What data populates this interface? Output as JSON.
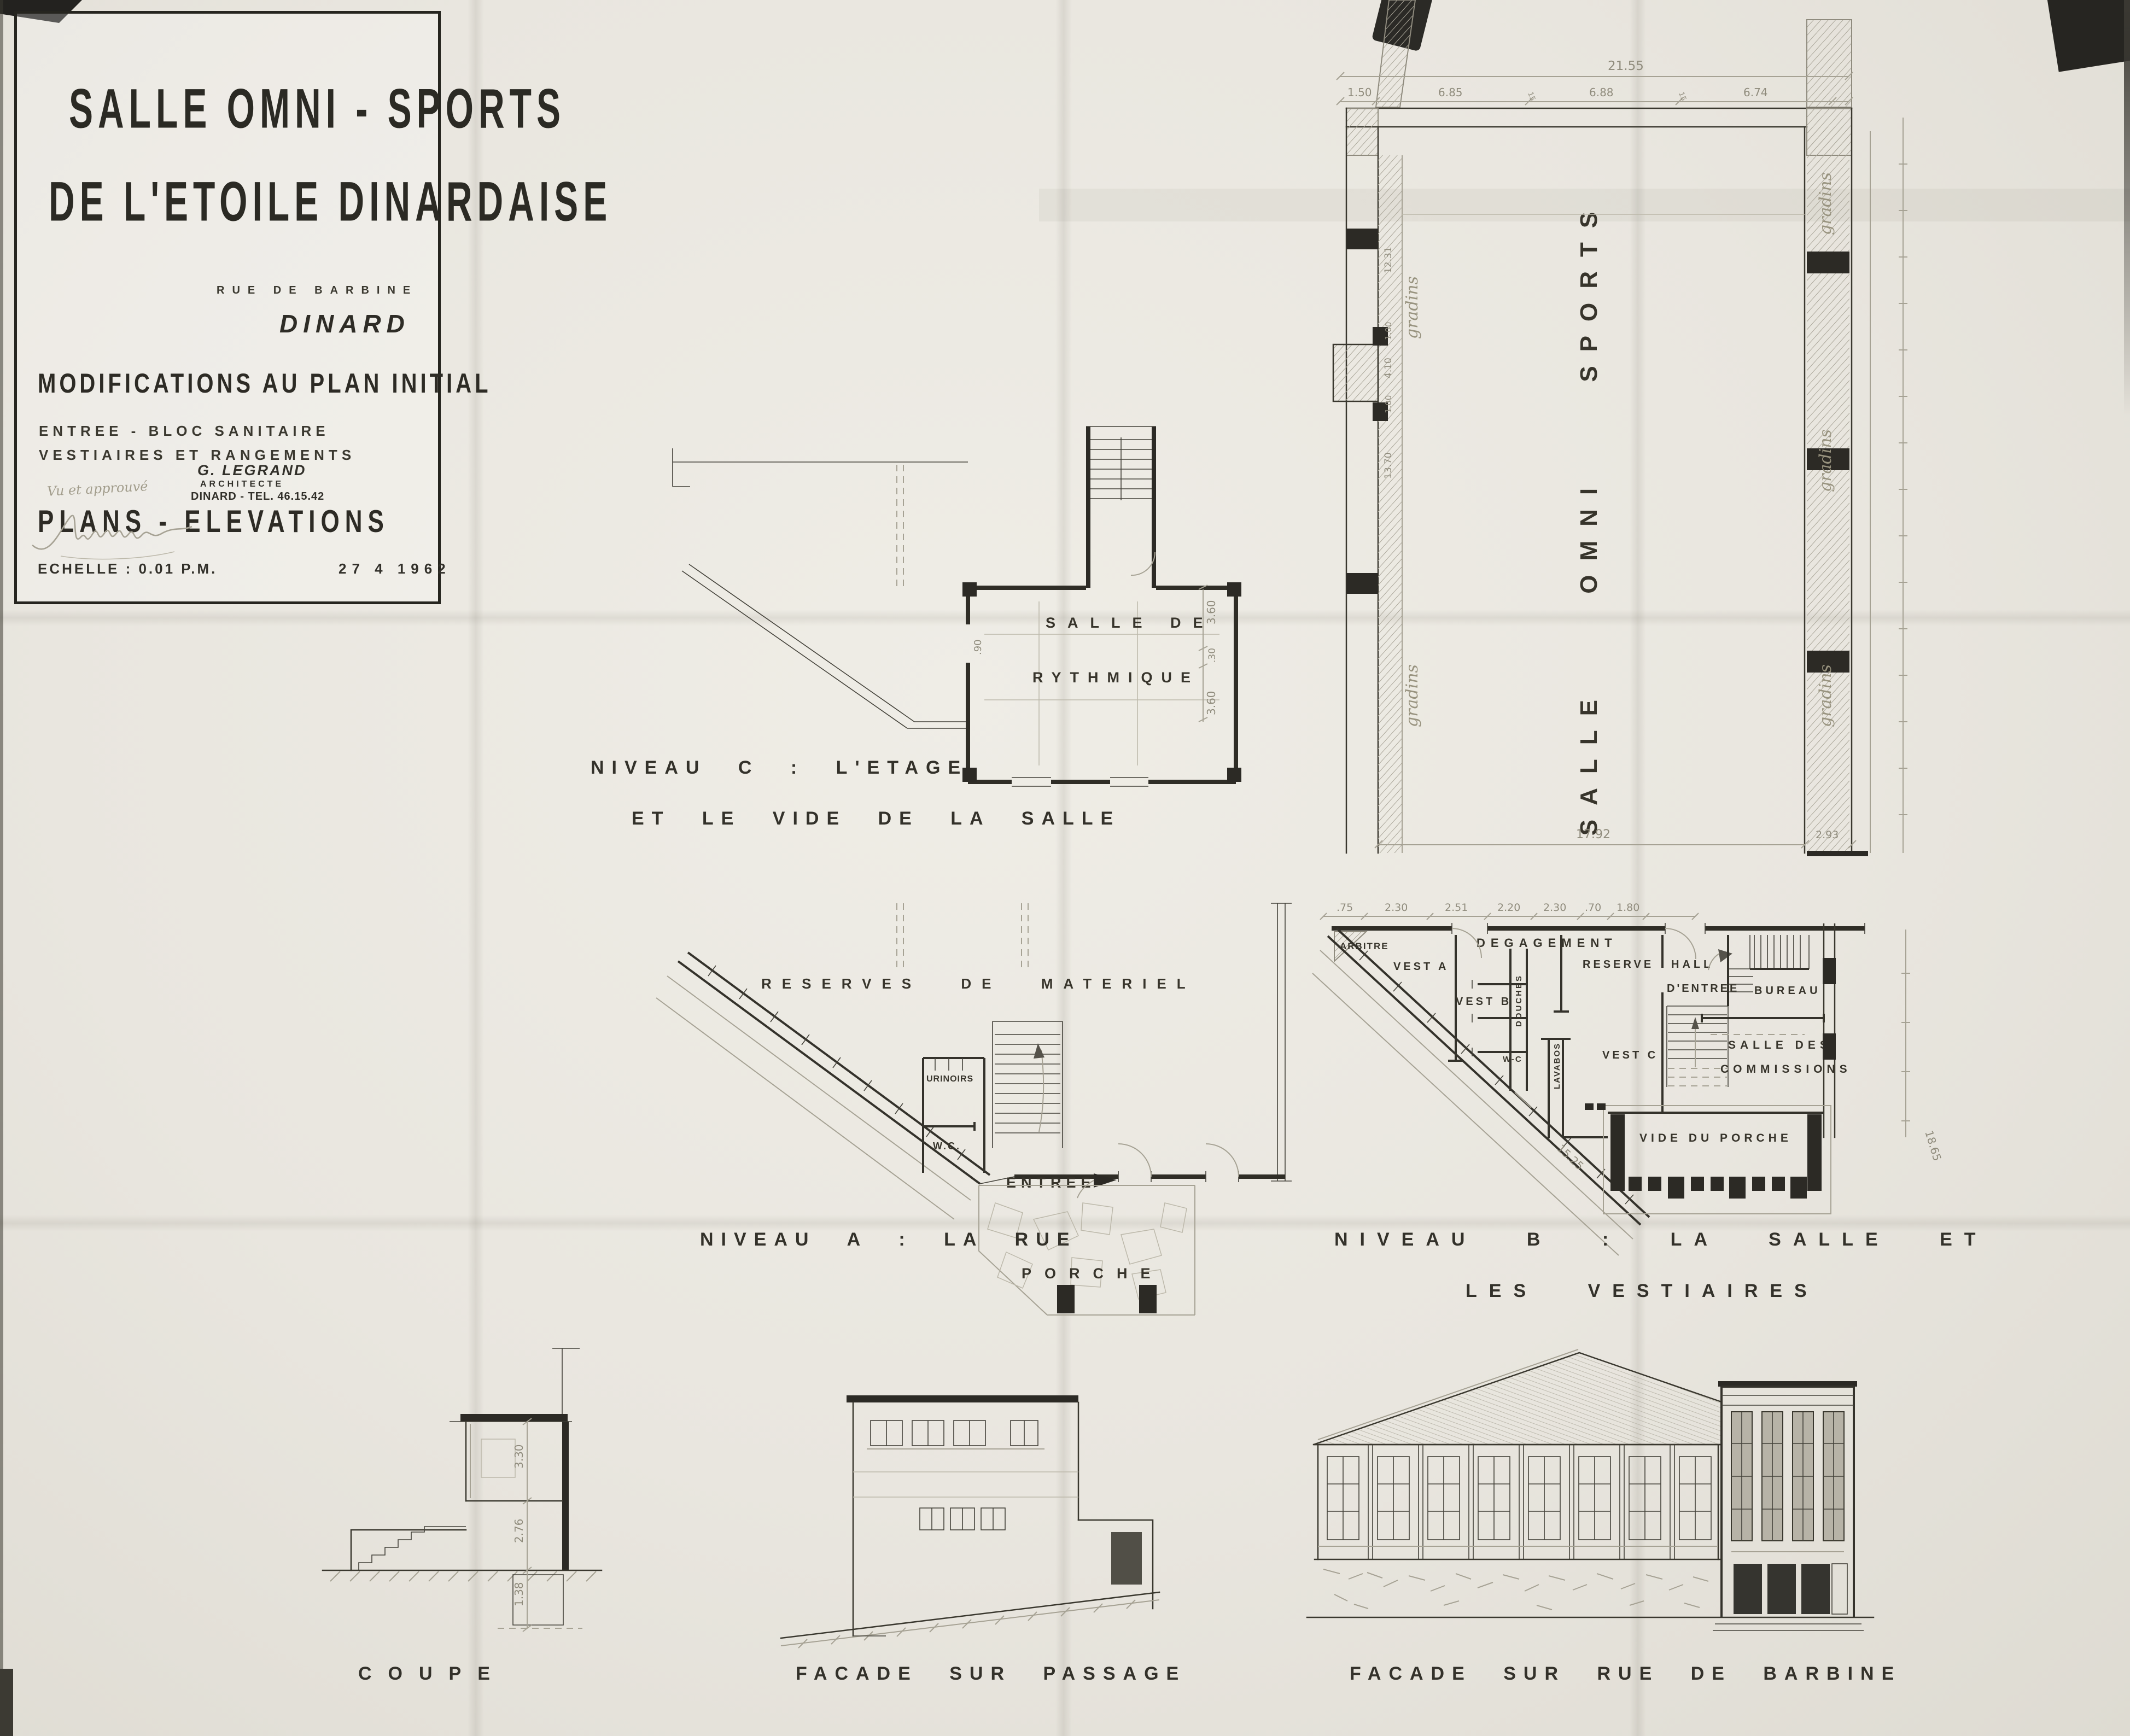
{
  "title_block": {
    "title_line1": "SALLE OMNI - SPORTS",
    "title_line2": "DE L'ETOILE DINARDAISE",
    "address": "RUE DE BARBINE",
    "city": "DINARD",
    "subject": "MODIFICATIONS AU PLAN INITIAL",
    "scope_line1": "ENTREE - BLOC SANITAIRE",
    "scope_line2": "VESTIAIRES ET RANGEMENTS",
    "doc_type": "PLANS - ELEVATIONS",
    "architect": {
      "name": "G. LEGRAND",
      "title": "ARCHITECTE",
      "contact": "DINARD - TEL. 46.15.42"
    },
    "approval": "Vu et approuvé",
    "scale": "ECHELLE : 0.01 P.M.",
    "date": "27 4 1962"
  },
  "niveau_c": {
    "caption1": "NIVEAU C : L'ETAGE",
    "caption2": "ET LE VIDE DE LA SALLE",
    "room_line1": "SALLE DE",
    "room_line2": "RYTHMIQUE",
    "dims": {
      "right_top": "3.60",
      "right_mid": ".30",
      "right_bottom": "3.60",
      "left": ".90"
    }
  },
  "niveau_a": {
    "caption": "NIVEAU A : LA RUE",
    "rooms": {
      "reserves": "RESERVES DE MATERIEL",
      "urinoirs": "URINOIRS",
      "wc": "W.C.",
      "entree": "ENTREE",
      "porche": "PORCHE"
    }
  },
  "niveau_b": {
    "caption1": "NIVEAU B : LA SALLE ET",
    "caption2": "LES VESTIAIRES",
    "hall": "SALLE OMNI SPORTS",
    "gradins": "gradins",
    "rooms": {
      "arbitre": "ARBITRE",
      "degagement": "DEGAGEMENT",
      "vest_a": "VEST A",
      "vest_b": "VEST B",
      "douches": "DOUCHES",
      "wc": "W-C",
      "lavabos": "LAVABOS",
      "reserve": "RESERVE",
      "vest_c": "VEST C",
      "hall_line1": "HALL",
      "hall_line2": "D'ENTREE",
      "bureau": "BUREAU",
      "commissions_line1": "SALLE DES",
      "commissions_line2": "COMMISSIONS",
      "vide_porche": "VIDE DU PORCHE"
    },
    "dims": {
      "total_top": "21.55",
      "seg1": "1.50",
      "seg2": "6.85",
      "seg3": "6.88",
      "seg4": "6.74",
      "wall": "15",
      "width": "17.92",
      "width_right": "2.93",
      "row1": ".75",
      "row2": "2.30",
      "row3": "2.51",
      "row4": "2.20",
      "row5": "2.30",
      "row6": ".70",
      "row7": "1.80",
      "diag": "15.25",
      "side": "18.65",
      "left1": "12.31",
      "left2": "1.00",
      "left3": "4.10",
      "left4": "1.00",
      "left5": "13.70"
    }
  },
  "elevations": {
    "coupe": {
      "caption": "COUPE",
      "dim1": "3.30",
      "dim2": "2.76",
      "dim3": "1.38"
    },
    "facade_passage": {
      "caption": "FACADE SUR PASSAGE"
    },
    "facade_barbine": {
      "caption": "FACADE SUR RUE DE BARBINE"
    }
  }
}
